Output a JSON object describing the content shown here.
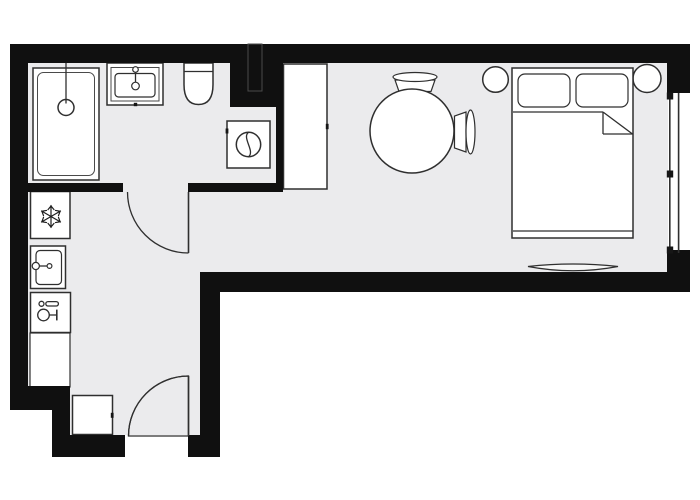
{
  "title": "studio-apartment-floor-plan",
  "canvas": {
    "width": 700,
    "height": 500
  },
  "colors": {
    "background": "#ffffff",
    "wall": "#101010",
    "floor": "#ebebed",
    "fixture": "#ffffff",
    "rug": "#f6f6f6",
    "line": "#2f2f2f"
  },
  "rooms": [
    {
      "id": "bathroom",
      "fixtures": [
        "bathtub",
        "wash-basin",
        "toilet",
        "washing-machine",
        "utility-shaft"
      ]
    },
    {
      "id": "kitchen-hallway",
      "fixtures": [
        "refrigerator",
        "kitchen-sink",
        "cooktop",
        "counter",
        "shoe-cabinet"
      ]
    },
    {
      "id": "living-room",
      "fixtures": [
        "wardrobe",
        "round-table",
        "chair-top",
        "chair-right",
        "double-bed",
        "pillow-left",
        "pillow-right",
        "nightstand-left",
        "nightstand-right",
        "rug"
      ]
    }
  ],
  "icons": {
    "refrigerator": "snowflake-icon",
    "washing_machine": "porthole-icon",
    "cooktop": "cookware-icon",
    "shower": "drain-icon"
  },
  "doors": [
    {
      "id": "bathroom-door",
      "swing": "quarter-arc"
    },
    {
      "id": "entry-door",
      "swing": "quarter-arc"
    }
  ],
  "windows": [
    {
      "id": "living-room-window",
      "wall": "right",
      "mullions": 3
    }
  ]
}
